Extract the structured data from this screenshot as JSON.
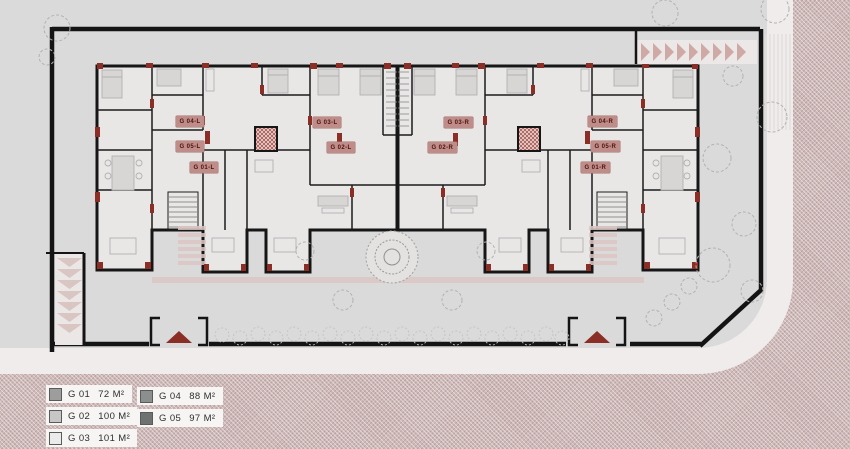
{
  "title": "Ground floor site plan",
  "colors": {
    "site_gray": "#dbdada",
    "road_pink": "#cdb9b8",
    "curb_white": "#efeceb",
    "wall_black": "#161616",
    "accent_red": "#8b2e25",
    "badge_bg": "#bf8d89",
    "badge_text": "#4f120d"
  },
  "plan": {
    "unit_labels": [
      {
        "text": "G 04-L"
      },
      {
        "text": "G 05-L"
      },
      {
        "text": "G 01-L"
      },
      {
        "text": "G 03-L"
      },
      {
        "text": "G 02-L"
      },
      {
        "text": "G 03-R"
      },
      {
        "text": "G 02-R"
      },
      {
        "text": "G 04-R"
      },
      {
        "text": "G 05-R"
      },
      {
        "text": "G 01-R"
      }
    ]
  },
  "legend": {
    "items": [
      {
        "code": "G 01",
        "area": "72 M²",
        "swatch": "#9d9d9d"
      },
      {
        "code": "G 02",
        "area": "100 M²",
        "swatch": "#c7c7c7"
      },
      {
        "code": "G 03",
        "area": "101 M²",
        "swatch": "#ebebeb"
      },
      {
        "code": "G 04",
        "area": "88 M²",
        "swatch": "#8b8f8e"
      },
      {
        "code": "G 05",
        "area": "97 M²",
        "swatch": "#6e7271"
      }
    ]
  }
}
